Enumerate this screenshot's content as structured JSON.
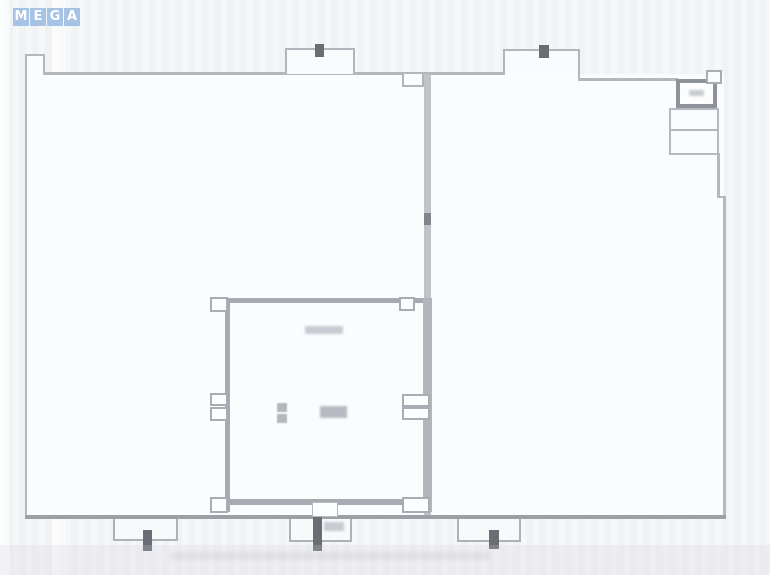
{
  "watermark": {
    "letters": [
      "M",
      "E",
      "G",
      "A"
    ]
  },
  "colors": {
    "watermark_tile": "#a6c3e5",
    "watermark_letter": "#ffffff",
    "background": "#f4f5f7",
    "plan_interior": "#fbfcfd",
    "wall_light": "#b4b8bd",
    "wall_bottom": "#9aa0a6",
    "inner_room_wall": "#a6abb1",
    "section_marker_dark": "#6a6e74",
    "vent_box_border": "#8e939a"
  }
}
